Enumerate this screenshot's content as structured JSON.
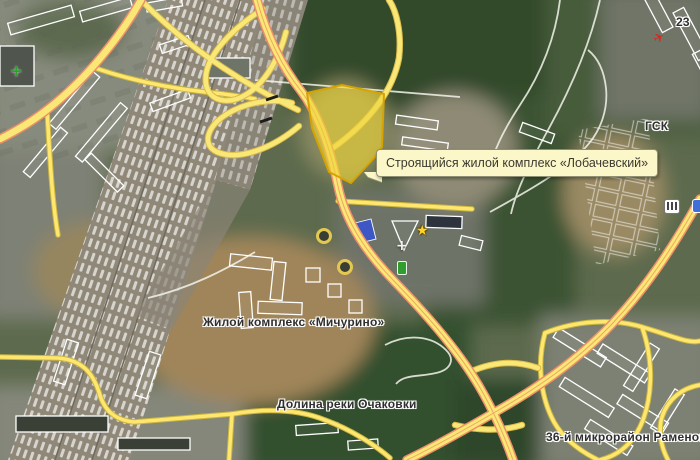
{
  "map": {
    "tooltip": {
      "text": "Строящийся жилой комплекс «Лобачевский»"
    },
    "labels": {
      "michurino": "Жилой комплекс «Мичурино»",
      "ochakovka_valley": "Долина реки Очаковки",
      "ramenki_36": "36-й микрорайон Раменок",
      "gsk": "ГСК",
      "building_number": "23"
    },
    "icons": {
      "green_plus": "+",
      "red_plane": "✈",
      "star": "★",
      "white_cross": "+"
    },
    "colors": {
      "road_fill": "#f9e876",
      "road_casing": "#ef8e6a",
      "minor_road_fill": "#ffe66e",
      "minor_road_casing": "#c9b53f",
      "highlight_fill": "#eed435",
      "highlight_border": "#d7a300",
      "tooltip_bg": "#fcf7c9",
      "tooltip_border": "#8f8f73",
      "label_text": "#2f2f2f",
      "rail_band": "#8f8878"
    }
  }
}
